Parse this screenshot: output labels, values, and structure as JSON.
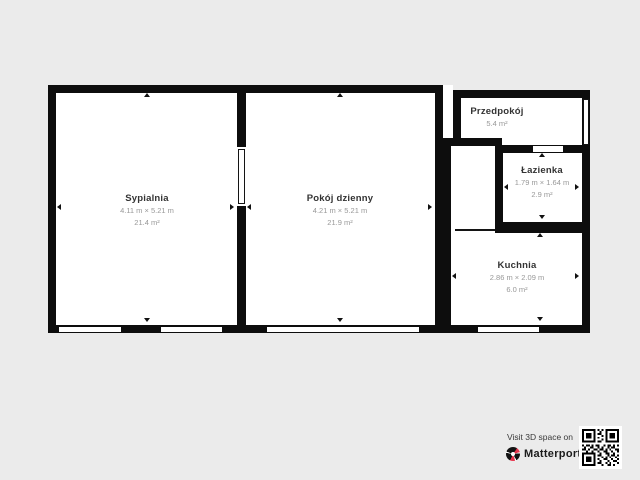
{
  "page": {
    "type": "floor-plan"
  },
  "colors": {
    "background": "#ebebeb",
    "wall": "#0d0d0d",
    "room_fill": "#ffffff",
    "room_name_text": "#333333",
    "room_dims_text": "#989898",
    "brand_red": "#e8354d"
  },
  "rooms": {
    "sypialnia": {
      "name": "Sypialnia",
      "dimensions": "4.11 m × 5.21 m",
      "area": "21.4 m²"
    },
    "pokoj_dzienny": {
      "name": "Pokój dzienny",
      "dimensions": "4.21 m × 5.21 m",
      "area": "21.9 m²"
    },
    "przedpokoj": {
      "name": "Przedpokój",
      "area": "5.4 m²"
    },
    "lazienka": {
      "name": "Łazienka",
      "dimensions": "1.79 m × 1.64 m",
      "area": "2.9 m²"
    },
    "kuchnia": {
      "name": "Kuchnia",
      "dimensions": "2.86 m × 2.09 m",
      "area": "6.0 m²"
    }
  },
  "footer": {
    "visit_text": "Visit 3D space on",
    "brand": "Matterport",
    "trademark": "™"
  }
}
